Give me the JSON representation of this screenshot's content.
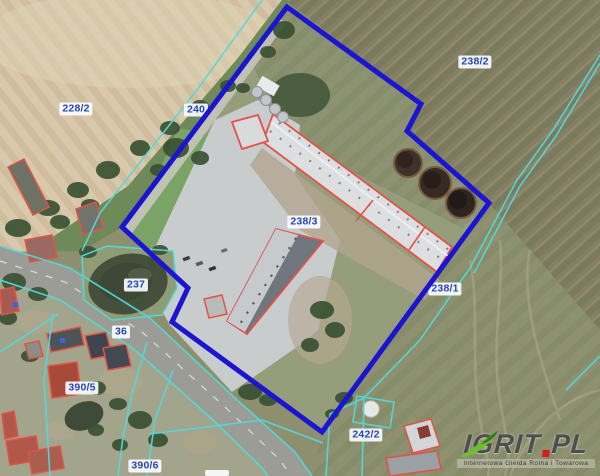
{
  "map": {
    "type": "cadastral-aerial-map",
    "parcel_labels": [
      {
        "label": "228/2"
      },
      {
        "label": "240"
      },
      {
        "label": "238/2"
      },
      {
        "label": "238/3"
      },
      {
        "label": "238/1"
      },
      {
        "label": "237"
      },
      {
        "label": "36"
      },
      {
        "label": "390/5"
      },
      {
        "label": "390/6"
      },
      {
        "label": "242/2"
      }
    ],
    "colors": {
      "selection_boundary": "#1b15d2",
      "cadastral_line": "#55d8da",
      "building_outline": "#e0534a",
      "label_text": "#2745b8",
      "label_background": "#fafcfe"
    }
  },
  "watermark": {
    "brand_left": "IGRIT",
    "brand_right": "PL",
    "tagline": "Internetowa Giełda Rolna i Towarowa",
    "brand_color": "#4e4e4e",
    "dot_color": "#d41f1f",
    "swoosh_color": "#6cbf30"
  }
}
